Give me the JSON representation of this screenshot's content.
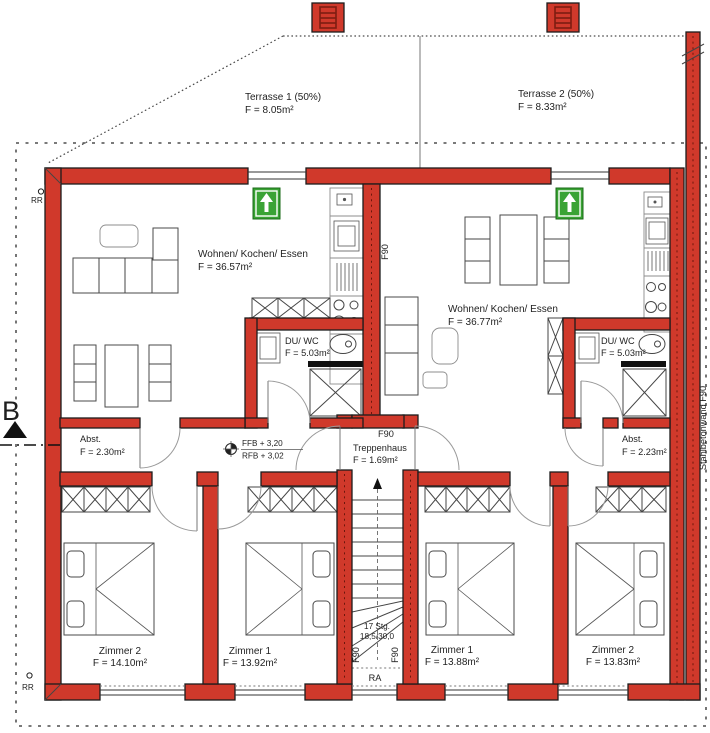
{
  "colors": {
    "wall_red": "#d0392b",
    "escape_green": "#3aa335"
  },
  "terraces": {
    "t1": {
      "name": "Terrasse 1 (50%)",
      "area": "F = 8.05m²"
    },
    "t2": {
      "name": "Terrasse 2 (50%)",
      "area": "F = 8.33m²"
    }
  },
  "rooms": {
    "wke_left": {
      "name": "Wohnen/ Kochen/ Essen",
      "area": "F = 36.57m²"
    },
    "wke_right": {
      "name": "Wohnen/ Kochen/ Essen",
      "area": "F = 36.77m²"
    },
    "duwc_left": {
      "name": "DU/ WC",
      "area": "F = 5.03m²"
    },
    "duwc_right": {
      "name": "DU/ WC",
      "area": "F = 5.03m²"
    },
    "abst_left": {
      "name": "Abst.",
      "area": "F = 2.30m²"
    },
    "abst_right": {
      "name": "Abst.",
      "area": "F = 2.23m²"
    },
    "treppenhaus": {
      "name": "Treppenhaus",
      "area": "F = 1.69m²"
    },
    "zimmer2_left": {
      "name": "Zimmer 2",
      "area": "F = 14.10m²"
    },
    "zimmer1_left": {
      "name": "Zimmer 1",
      "area": "F = 13.92m²"
    },
    "zimmer1_right": {
      "name": "Zimmer 1",
      "area": "F = 13.88m²"
    },
    "zimmer2_right": {
      "name": "Zimmer 2",
      "area": "F = 13.83m²"
    }
  },
  "annotations": {
    "f90": "F90",
    "stahlbetonwand": "Stahlbetonwand F90",
    "rr": "RR",
    "ra": "RA",
    "ffb": "FFB + 3,20",
    "rfb": "RFB + 3,02",
    "stairs_line1": "17 Stg.",
    "stairs_line2": "18,5/30,0",
    "section": "B"
  }
}
